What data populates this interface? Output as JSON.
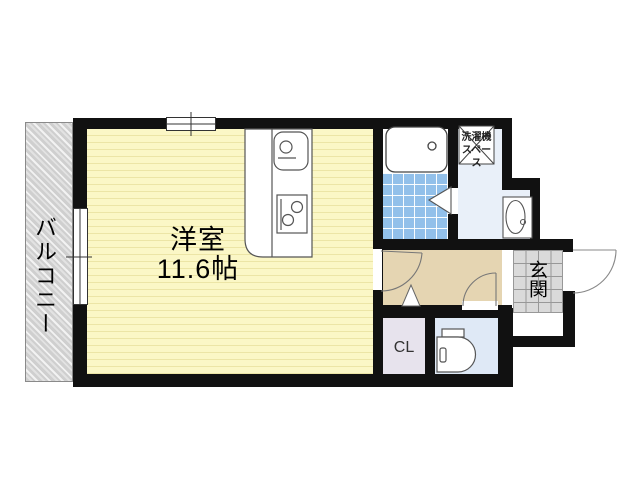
{
  "plan_type": "apartment-floor-plan",
  "rooms": {
    "main_room": {
      "label": "洋室",
      "size": "11.6帖"
    },
    "balcony": {
      "label": "バルコニー"
    },
    "entrance": {
      "label": "玄関"
    },
    "closet": {
      "label": "CL"
    },
    "washing_machine_space": {
      "line1": "洗濯機",
      "line2": "スペース"
    }
  },
  "fixtures": {
    "bathtub": "bathtub",
    "kitchen_sink": "kitchen-sink",
    "kitchen_stove": "kitchen-stove-2-burner",
    "wash_basin": "wash-basin",
    "toilet": "toilet",
    "doors": [
      "room-hallway-door",
      "toilet-door",
      "entrance-door",
      "bathroom-folding-door"
    ],
    "windows": [
      "top-wall-sliding-window",
      "balcony-sliding-window"
    ]
  },
  "colors": {
    "wall": "#111111",
    "main_room_fill": "#fbf7c6",
    "main_room_stripe": "#ece5a6",
    "balcony_fill": "#d9d9d9",
    "hallway_fill": "#e5d5b2",
    "bathroom_tile": "#92c0ea",
    "washroom_fill": "#e9f0f9",
    "toilet_fill": "#dfe9f6",
    "closet_fill": "#e7e3ed",
    "entrance_tile": "#dadada"
  }
}
